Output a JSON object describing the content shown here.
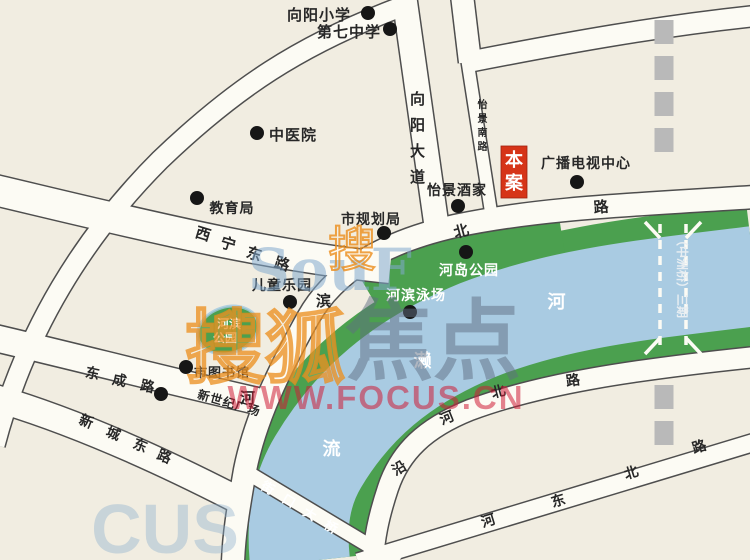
{
  "map": {
    "colors": {
      "background": "#f1ede1",
      "water": "#a9cbe2",
      "bank_green": "#4ba04f",
      "road_fill": "#fcfbf4",
      "road_edge": "#4e4e4e",
      "label_dark": "#272727",
      "label_white": "#ffffff",
      "dot_black": "#161616",
      "planned_gray": "#b9b9b9",
      "marker_red": "#d63418"
    },
    "landmarks": [
      {
        "id": "xiangyang-primary-school",
        "label": "向阳小学",
        "x": 319,
        "y": 20,
        "size": 15,
        "dot": [
          368,
          13
        ]
      },
      {
        "id": "no7-middle-school",
        "label": "第七中学",
        "x": 349,
        "y": 37,
        "size": 15,
        "dot": [
          390,
          29
        ]
      },
      {
        "id": "chinese-medicine-hospital",
        "label": "中医院",
        "x": 293,
        "y": 140,
        "size": 15,
        "dot": [
          257,
          133
        ]
      },
      {
        "id": "education-bureau",
        "label": "教育局",
        "x": 232,
        "y": 213,
        "size": 14,
        "dot": [
          197,
          198
        ]
      },
      {
        "id": "city-planning-bureau",
        "label": "市规划局",
        "x": 371,
        "y": 224,
        "size": 14,
        "dot": [
          384,
          233
        ]
      },
      {
        "id": "yijing-restaurant",
        "label": "怡景酒家",
        "x": 457,
        "y": 195,
        "size": 14,
        "dot": [
          458,
          206
        ]
      },
      {
        "id": "broadcast-tv-center",
        "label": "广播电视中心",
        "x": 586,
        "y": 168,
        "size": 14,
        "dot": [
          577,
          182
        ]
      },
      {
        "id": "children-playground",
        "label": "儿童乐园",
        "x": 282,
        "y": 290,
        "size": 14,
        "dot": [
          290,
          302
        ]
      },
      {
        "id": "river-island-park",
        "label": "河岛公园",
        "x": 469,
        "y": 275,
        "size": 14,
        "color": "#ffffff",
        "dot": [
          466,
          252
        ]
      },
      {
        "id": "riverside-swimming-pool",
        "label": "河滨泳场",
        "x": 416,
        "y": 300,
        "size": 14,
        "color": "#ffffff",
        "dot": [
          410,
          312
        ]
      },
      {
        "id": "city-library",
        "label": "市图书馆",
        "x": 222,
        "y": 377,
        "size": 13,
        "dot": [
          186,
          367
        ]
      },
      {
        "id": "new-century-plaza",
        "label": "新世纪广场",
        "x": 228,
        "y": 407,
        "size": 12,
        "rot": 16,
        "dot": [
          161,
          394
        ]
      }
    ],
    "park_blob": {
      "id": "riverside-park",
      "lines": [
        "河滨",
        "公园"
      ],
      "cx": 228,
      "cy": 330,
      "rx": 31,
      "ry": 23,
      "rot": -18,
      "text_color": "#ffffff",
      "text_size": 12
    },
    "project_marker": {
      "id": "benan-marker",
      "label": "本案",
      "x": 501,
      "y": 146,
      "w": 26,
      "h": 52,
      "bg": "#d63418",
      "text_color": "#ffffff",
      "size": 18
    },
    "road_labels": [
      {
        "id": "hebin-north-road",
        "name": "河滨北路",
        "size": 15,
        "chars": [
          {
            "ch": "河",
            "x": 248,
            "y": 403,
            "rot": 0
          },
          {
            "ch": "滨",
            "x": 324,
            "y": 306,
            "rot": 0
          },
          {
            "ch": "北",
            "x": 463,
            "y": 236,
            "rot": -15
          },
          {
            "ch": "路",
            "x": 602,
            "y": 212,
            "rot": -5
          }
        ]
      },
      {
        "id": "yanhe-north-road",
        "name": "沿河北路",
        "size": 14,
        "chars": [
          {
            "ch": "沿",
            "x": 402,
            "y": 472,
            "rot": -30
          },
          {
            "ch": "河",
            "x": 449,
            "y": 422,
            "rot": -22
          },
          {
            "ch": "北",
            "x": 500,
            "y": 396,
            "rot": -15
          },
          {
            "ch": "路",
            "x": 574,
            "y": 385,
            "rot": -8
          }
        ]
      },
      {
        "id": "hedong-north-road",
        "name": "河东北路",
        "size": 14,
        "chars": [
          {
            "ch": "河",
            "x": 490,
            "y": 525,
            "rot": -17
          },
          {
            "ch": "东",
            "x": 560,
            "y": 505,
            "rot": -17
          },
          {
            "ch": "北",
            "x": 633,
            "y": 477,
            "rot": -17
          },
          {
            "ch": "路",
            "x": 701,
            "y": 451,
            "rot": -17
          }
        ]
      },
      {
        "id": "xining-east-road",
        "name": "西宁东路",
        "size": 15,
        "chars": [
          {
            "ch": "西",
            "x": 202,
            "y": 239,
            "rot": 17
          },
          {
            "ch": "宁",
            "x": 227,
            "y": 249,
            "rot": 17
          },
          {
            "ch": "东",
            "x": 253,
            "y": 259,
            "rot": 17
          },
          {
            "ch": "路",
            "x": 281,
            "y": 269,
            "rot": 17
          }
        ]
      },
      {
        "id": "dongcheng-road",
        "name": "东成路",
        "size": 14,
        "chars": [
          {
            "ch": "东",
            "x": 92,
            "y": 378,
            "rot": 12
          },
          {
            "ch": "成",
            "x": 119,
            "y": 385,
            "rot": 12
          },
          {
            "ch": "路",
            "x": 147,
            "y": 391,
            "rot": 12
          }
        ]
      },
      {
        "id": "xincheng-east-road",
        "name": "新城东路",
        "size": 14,
        "chars": [
          {
            "ch": "新",
            "x": 85,
            "y": 426,
            "rot": 22
          },
          {
            "ch": "城",
            "x": 112,
            "y": 438,
            "rot": 22
          },
          {
            "ch": "东",
            "x": 139,
            "y": 450,
            "rot": 22
          },
          {
            "ch": "路",
            "x": 163,
            "y": 461,
            "rot": 22
          }
        ]
      },
      {
        "id": "xiangyang-avenue",
        "name": "向阳大道",
        "size": 15,
        "chars": [
          {
            "ch": "向",
            "x": 418,
            "y": 104,
            "rot": 0
          },
          {
            "ch": "阳",
            "x": 418,
            "y": 130,
            "rot": 0
          },
          {
            "ch": "大",
            "x": 418,
            "y": 156,
            "rot": 0
          },
          {
            "ch": "道",
            "x": 418,
            "y": 182,
            "rot": 0
          }
        ]
      },
      {
        "id": "yijing-south-road",
        "name": "怡景南路",
        "size": 10,
        "chars": [
          {
            "ch": "怡",
            "x": 483,
            "y": 108,
            "rot": 0
          },
          {
            "ch": "景",
            "x": 483,
            "y": 122,
            "rot": 0
          },
          {
            "ch": "南",
            "x": 483,
            "y": 136,
            "rot": 0
          },
          {
            "ch": "路",
            "x": 483,
            "y": 150,
            "rot": 0
          }
        ]
      }
    ],
    "river_labels": {
      "id": "river-name",
      "size": 18,
      "color": "#ffffff",
      "chars": [
        {
          "ch": "河",
          "x": 557,
          "y": 308,
          "rot": 0
        },
        {
          "ch": "濑",
          "x": 423,
          "y": 367,
          "rot": 0
        },
        {
          "ch": "流",
          "x": 332,
          "y": 455,
          "rot": 0
        }
      ]
    },
    "bridge_label": {
      "id": "jiekou-bridge-label",
      "name": "街口大桥",
      "size": 13,
      "color": "#ffffff",
      "chars": [
        {
          "ch": "街",
          "x": 266,
          "y": 492,
          "rot": 31
        },
        {
          "ch": "口",
          "x": 287,
          "y": 505,
          "rot": 31
        },
        {
          "ch": "大",
          "x": 308,
          "y": 518,
          "rot": 31
        },
        {
          "ch": "桥",
          "x": 329,
          "y": 531,
          "rot": 31
        }
      ]
    },
    "planned_bridge_label": {
      "id": "zhongzhou-bridge-label",
      "text": "（中洲桥）三期",
      "x": 678,
      "y": 234,
      "rot": 90,
      "size": 12,
      "color": "#e8eef2"
    },
    "watermarks": [
      {
        "id": "watermark-soufun-latin",
        "text": "SouF",
        "x": 330,
        "y": 290,
        "size": 58,
        "color": "rgba(130,170,205,0.55)",
        "serif": true,
        "weight": "bold"
      },
      {
        "id": "watermark-sohu-char-small",
        "text": "搜",
        "x": 352,
        "y": 266,
        "size": 48,
        "hollow": true,
        "color": "rgba(235,140,25,0.8)"
      },
      {
        "id": "watermark-sohu-chars",
        "text": "搜狐",
        "x": 265,
        "y": 376,
        "size": 80,
        "hollow": true,
        "color": "rgba(235,140,25,0.75)",
        "weight": "bold"
      },
      {
        "id": "watermark-focus-chars",
        "text": "焦点",
        "x": 433,
        "y": 372,
        "size": 88,
        "color": "rgba(95,110,130,0.5)",
        "weight": "bold"
      },
      {
        "id": "watermark-focus-url",
        "text": "WWW.FOCUS.CN",
        "x": 376,
        "y": 409,
        "size": 33,
        "color": "rgba(205,30,55,0.55)",
        "weight": "bold",
        "ls": 2
      },
      {
        "id": "watermark-focus-partial",
        "text": "CUS",
        "x": 165,
        "y": 553,
        "size": 70,
        "color": "rgba(140,175,205,0.4)",
        "weight": "bold"
      }
    ]
  }
}
